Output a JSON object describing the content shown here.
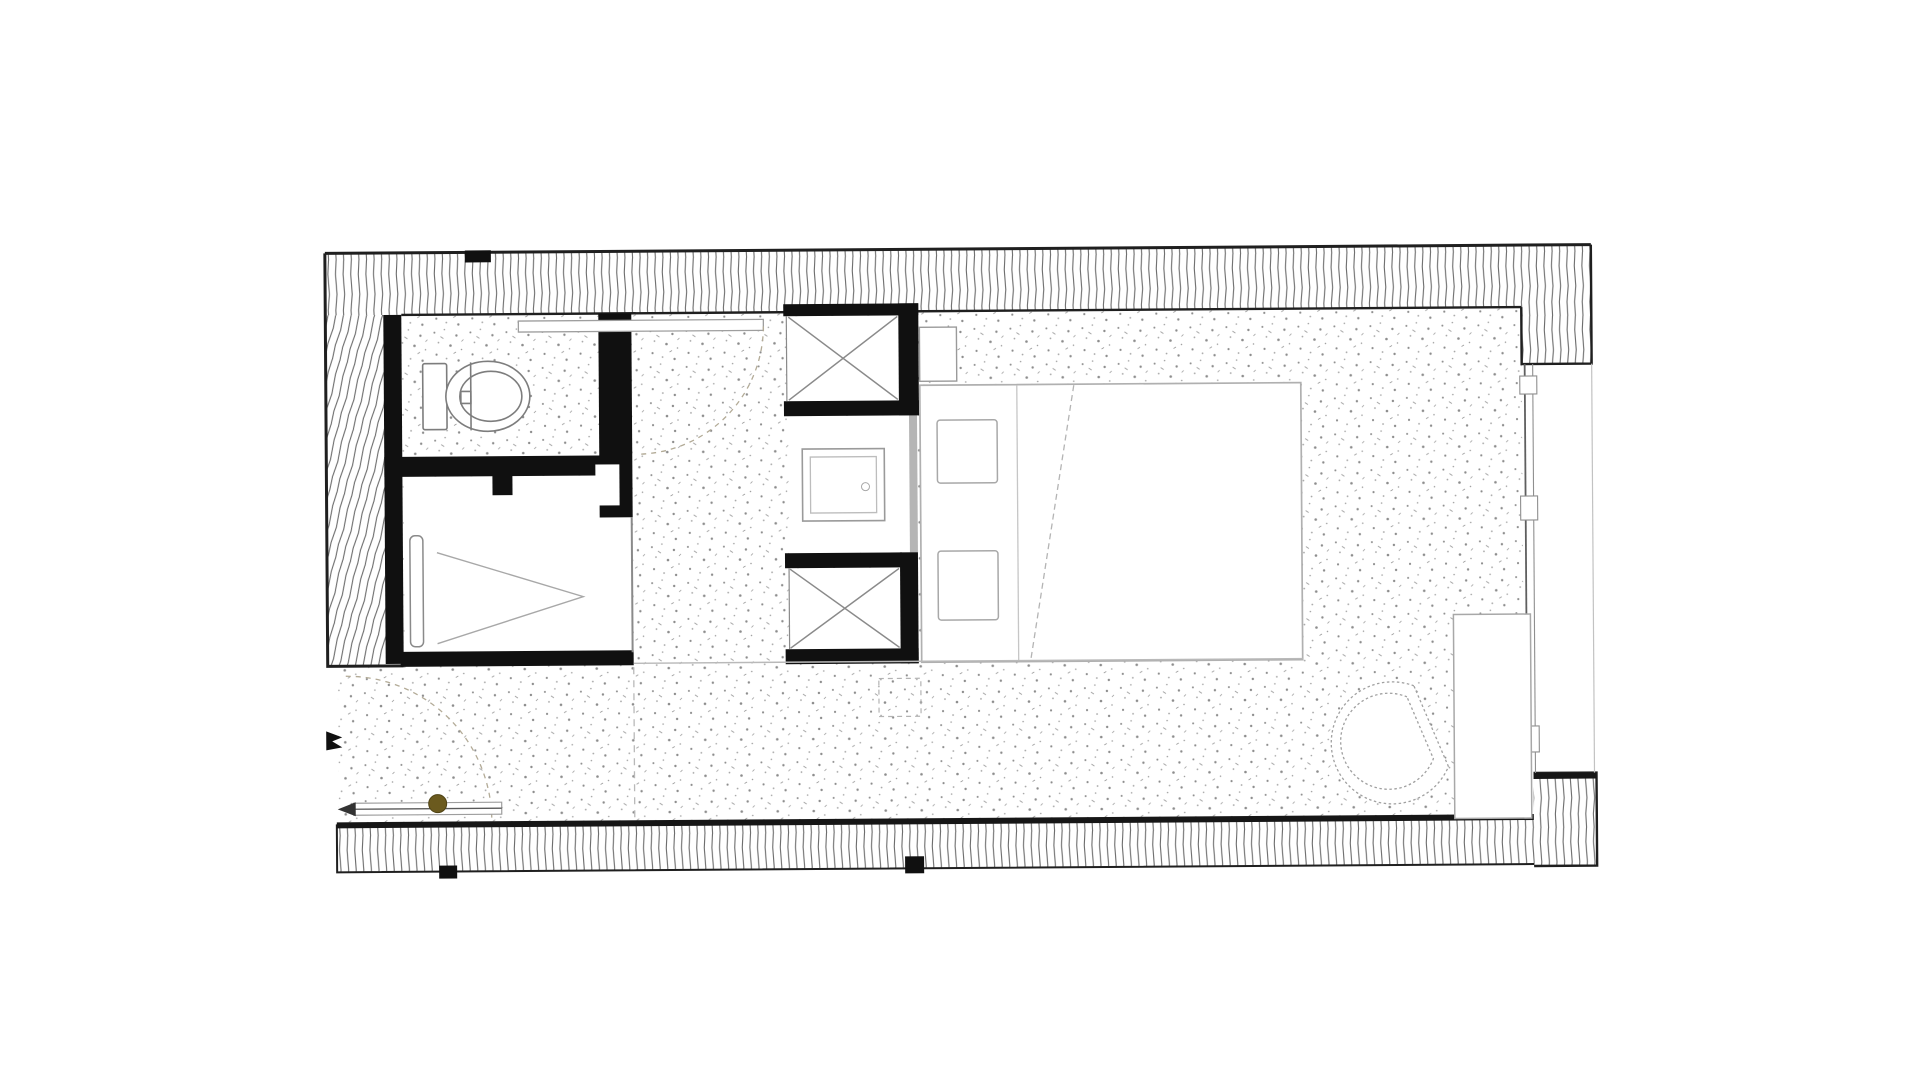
{
  "page": {
    "background": "#ffffff",
    "title": "Architectural floor plan drawing (no text labels visible)"
  },
  "colors": {
    "ink": "#1f1f1f",
    "wall_black": "#101010",
    "hatch_line": "#6b6b6b",
    "furniture_line": "#a3a3a3",
    "light_line": "#bdbdbd",
    "stipple": "#8d8d8d",
    "arc_dash": "#b3ab97",
    "marker_olive": "#6b5a1e",
    "background": "#ffffff"
  },
  "plan": {
    "type": "floor-plan",
    "style": "scanned black-ink architectural plan; hatched poche walls, stippled floor finish, light-grey furniture",
    "rooms": [
      {
        "name": "wc",
        "fixtures": [
          "toilet-with-cistern"
        ]
      },
      {
        "name": "shower-room",
        "fixtures": [
          "shower-chevron-symbol",
          "glass-screen"
        ]
      },
      {
        "name": "entry-corridor",
        "fixtures": [
          "entry-door-leaf",
          "entry-swing-arc",
          "entry-direction-arrow",
          "olive-marker-dot"
        ]
      },
      {
        "name": "wardrobe-niche",
        "fixtures": [
          "upper-shaft-x-box",
          "lower-shaft-x-box",
          "luggage-table-double-square"
        ]
      },
      {
        "name": "bedroom",
        "fixtures": [
          "double-bed",
          "pillow-left",
          "pillow-right",
          "fold-line",
          "bedside-box",
          "bathroom-door-swing",
          "door-leaf-on-wall"
        ]
      },
      {
        "name": "window-zone",
        "fixtures": [
          "curtain-wall-glazing",
          "mullion-1",
          "mullion-2",
          "mullion-3",
          "desk-console",
          "lounge-chair"
        ]
      }
    ],
    "wall_systems": {
      "exterior": [
        "top-band-hatched",
        "left-band-hatched",
        "bottom-band-hatched",
        "top-right-return",
        "bottom-right-corner-block"
      ],
      "interior_black": [
        "wc-left-lining",
        "wc-shower-divider",
        "wc-right-wall-and-jamb",
        "shower-bottom-wall",
        "shaft-walls"
      ]
    },
    "annotations": [
      "black-tick-top-wall",
      "black-tick-bottom-wall-left",
      "black-tick-bottom-wall-center",
      "entry-frame-glyph",
      "dashed-threshold-line",
      "dashed-ceiling-square"
    ]
  }
}
